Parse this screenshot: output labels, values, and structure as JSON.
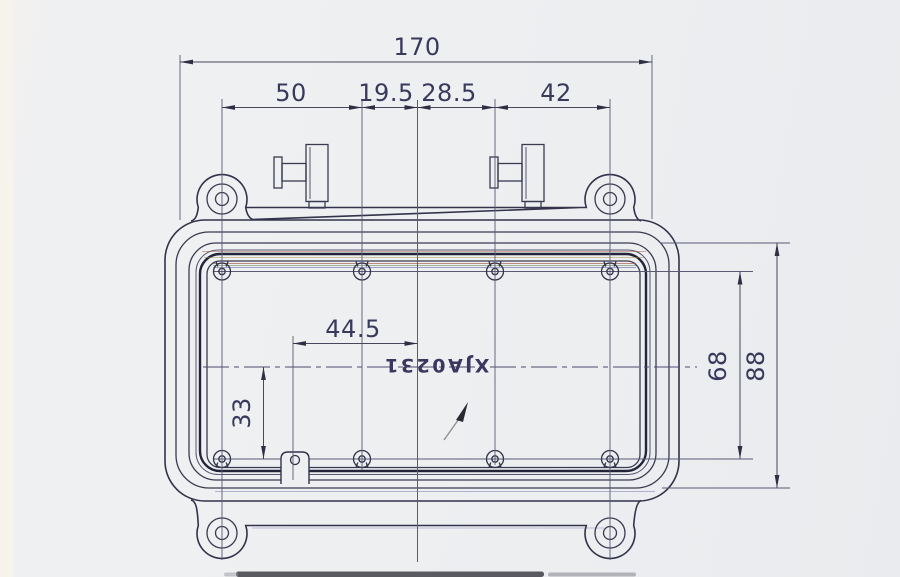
{
  "drawing": {
    "part_number": "XJA0231",
    "dimensions": {
      "overall_width": "170",
      "pitch_left": "50",
      "pitch_center_left": "19.5",
      "pitch_center_right": "28.5",
      "pitch_right": "42",
      "offset_horizontal": "44.5",
      "offset_vertical": "33",
      "hole_rows_spacing": "68",
      "overall_height": "88"
    },
    "colors": {
      "ink": "#32324a",
      "paper": "#edeff1",
      "fringe_red": "#a85f4e",
      "fringe_green": "#6f9367",
      "fringe_blue": "#7373ae"
    }
  }
}
